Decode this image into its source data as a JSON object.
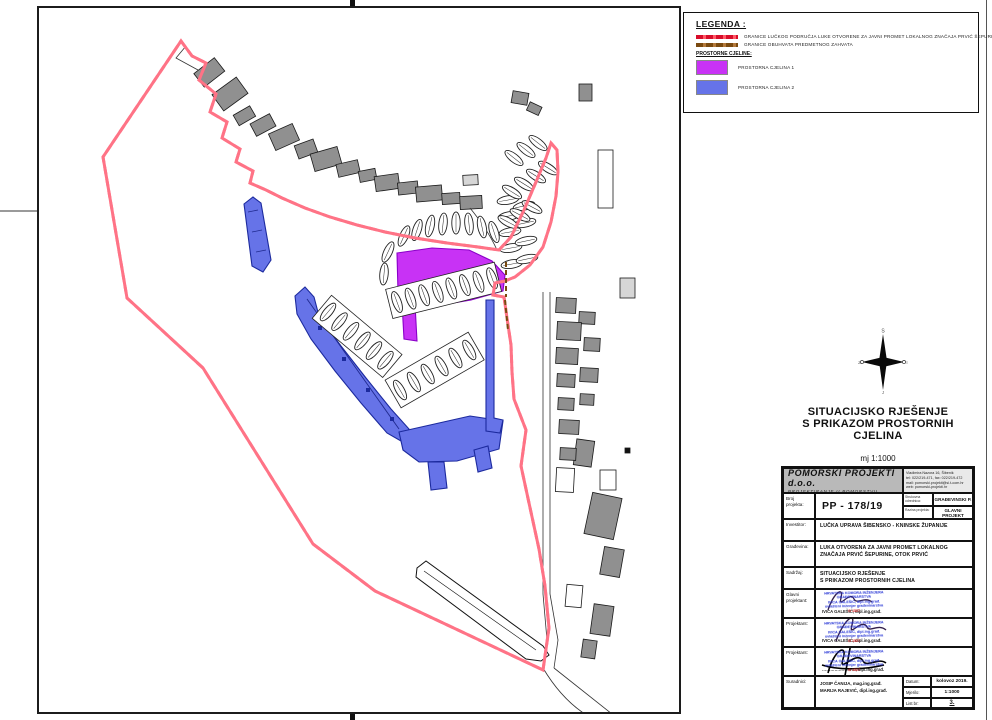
{
  "legend": {
    "title": "LEGENDA :",
    "items": [
      {
        "label": "GRANICE LUČKOG PODRUČJA LUKE OTVORENE ZA JAVNI PROMET LOKALNOG ZNAČAJA PRVIĆ ŠEPURINE",
        "color": "#d80c2a",
        "style": "dashed-line"
      },
      {
        "label": "GRANICE OBUHVATA PREDMETNOG ZAHVATA",
        "color": "#7a4a10",
        "style": "dashed-line"
      }
    ],
    "subtitle": "PROSTORNE CJELINE:",
    "zones": [
      {
        "label": "PROSTORNA CJELINA 1",
        "color": "#c832f5"
      },
      {
        "label": "PROSTORNA CJELINA 2",
        "color": "#6673e8"
      }
    ]
  },
  "compass": {
    "north": "S",
    "east": "I",
    "south": "J",
    "west": "Z"
  },
  "drawing_title": {
    "line1": "SITUACIJSKO RJEŠENJE",
    "line2": "S PRIKAZOM PROSTORNIH CJELINA",
    "scale_note": "mj 1:1000"
  },
  "title_block": {
    "company": {
      "name": "POMORSKI PROJEKTI d.o.o.",
      "tagline": "PROJEKTIRANJE U POMORSTVU",
      "address_lines": [
        "Vladimira Nazora 16, Šibenik",
        "tel: 022/219-471, fax: 022/219-472",
        "mail: pomorski.projekti@si.t-com.hr",
        "web: pomorski-projekti.hr"
      ]
    },
    "rows": {
      "broj_label": "Broj projekta:",
      "broj_value": "PP - 178/19",
      "tip_label": "Strukovna odrednica:",
      "tip_value": "GRAĐEVINSKI P.",
      "razina_label": "Razina projekta:",
      "razina_value": "GLAVNI PROJEKT",
      "investitor_label": "Investitor:",
      "investitor_value": "LUČKA UPRAVA ŠIBENSKO - KNINSKE ŽUPANIJE",
      "gradjevina_label": "Građevina:",
      "gradjevina_value1": "LUKA OTVORENA ZA JAVNI PROMET LOKALNOG",
      "gradjevina_value2": "ZNAČAJA PRVIĆ ŠEPURINE, OTOK PRVIĆ",
      "sadrzaj_label": "Sadržaj:",
      "sadrzaj_value1": "SITUACIJSKO RJEŠENJE",
      "sadrzaj_value2": "S PRIKAZOM PROSTORNIH CJELINA",
      "glavni_label": "Glavni projektant:",
      "glavni_name": "IVICA GALEŠIĆ, dipl.ing.građ.",
      "projektant1_label": "Projektant:",
      "projektant1_name": "IVICA GALEŠIĆ, dipl.ing.građ.",
      "projektant2_label": "Projektant:",
      "projektant2_name": "……………………, dipl.ing.građ.",
      "suradnici_label": "Suradnici:",
      "suradnici": [
        "JOSIP ČANIJA, mag.ing.građ.",
        "MARIJA RAJEVIĆ, dipl.ing.građ."
      ],
      "datum_label": "Datum:",
      "datum_value": "kolovoz 2019.",
      "mjerilo_label": "Mjerilo:",
      "mjerilo_value": "1:1000",
      "list_label": "List br:",
      "list_value": "3."
    },
    "stamp": {
      "lines": [
        "HRVATSKA KOMORA INŽENJERA",
        "GRAĐEVINARSTVA",
        "IVICA GALEŠIĆ, dipl.ing.građ.",
        "ovlašteni inženjer građevinarstva"
      ],
      "code": "G 1527"
    }
  },
  "map": {
    "boundary_color": "#f01440",
    "obuhvat_color": "#7a4a10",
    "zone1_color": "#c832f5",
    "zone2_color": "#6673e8",
    "building_color": "#909090"
  }
}
